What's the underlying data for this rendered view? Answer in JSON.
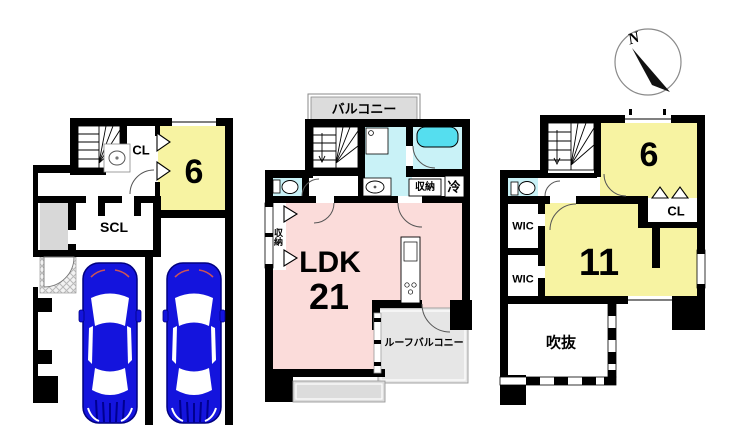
{
  "compass": {
    "north_label": "N"
  },
  "floor1": {
    "room6_label": "6",
    "cl_label": "CL",
    "scl_label": "SCL"
  },
  "floor2": {
    "balcony_label": "バルコニー",
    "storage_label": "収納",
    "storage_side_label": "収納",
    "fridge_label": "冷",
    "ldk_label": "LDK",
    "ldk_size_label": "21",
    "roof_balcony_label": "ルーフバルコニー"
  },
  "floor3": {
    "room6_label": "6",
    "cl_label": "CL",
    "room11_label": "11",
    "wic1_label": "WIC",
    "wic2_label": "WIC",
    "void_label": "吹抜"
  },
  "colors": {
    "wall": "#000000",
    "room_yellow": "#F7F3A2",
    "room_pink": "#FBDCDA",
    "wet_cyan": "#C9F2F7",
    "fixture_cyan": "#55DEEF",
    "balcony_gray": "#DCDCDC",
    "car_blue": "#1414DD"
  }
}
